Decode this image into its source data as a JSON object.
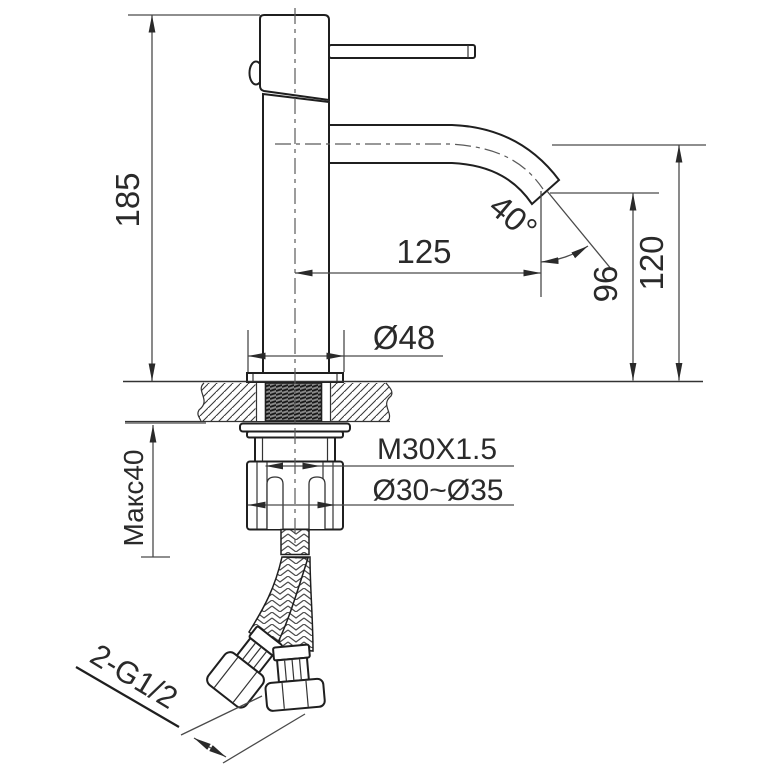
{
  "drawing": {
    "title": "Basin mixer faucet installation dimensions",
    "labels": {
      "height_total": "185",
      "spout_reach": "125",
      "spout_angle": "40°",
      "outlet_height": "96",
      "spout_height": "120",
      "base_diameter": "Ø48",
      "thread_spec": "M30X1.5",
      "hole_range": "Ø30~Ø35",
      "max_counter_thickness": "Макс40",
      "hose_thread": "2-G1/2"
    },
    "colors": {
      "object_line": "#1f1f1f",
      "dimension_line": "#4a4a4a",
      "background": "#ffffff"
    }
  }
}
